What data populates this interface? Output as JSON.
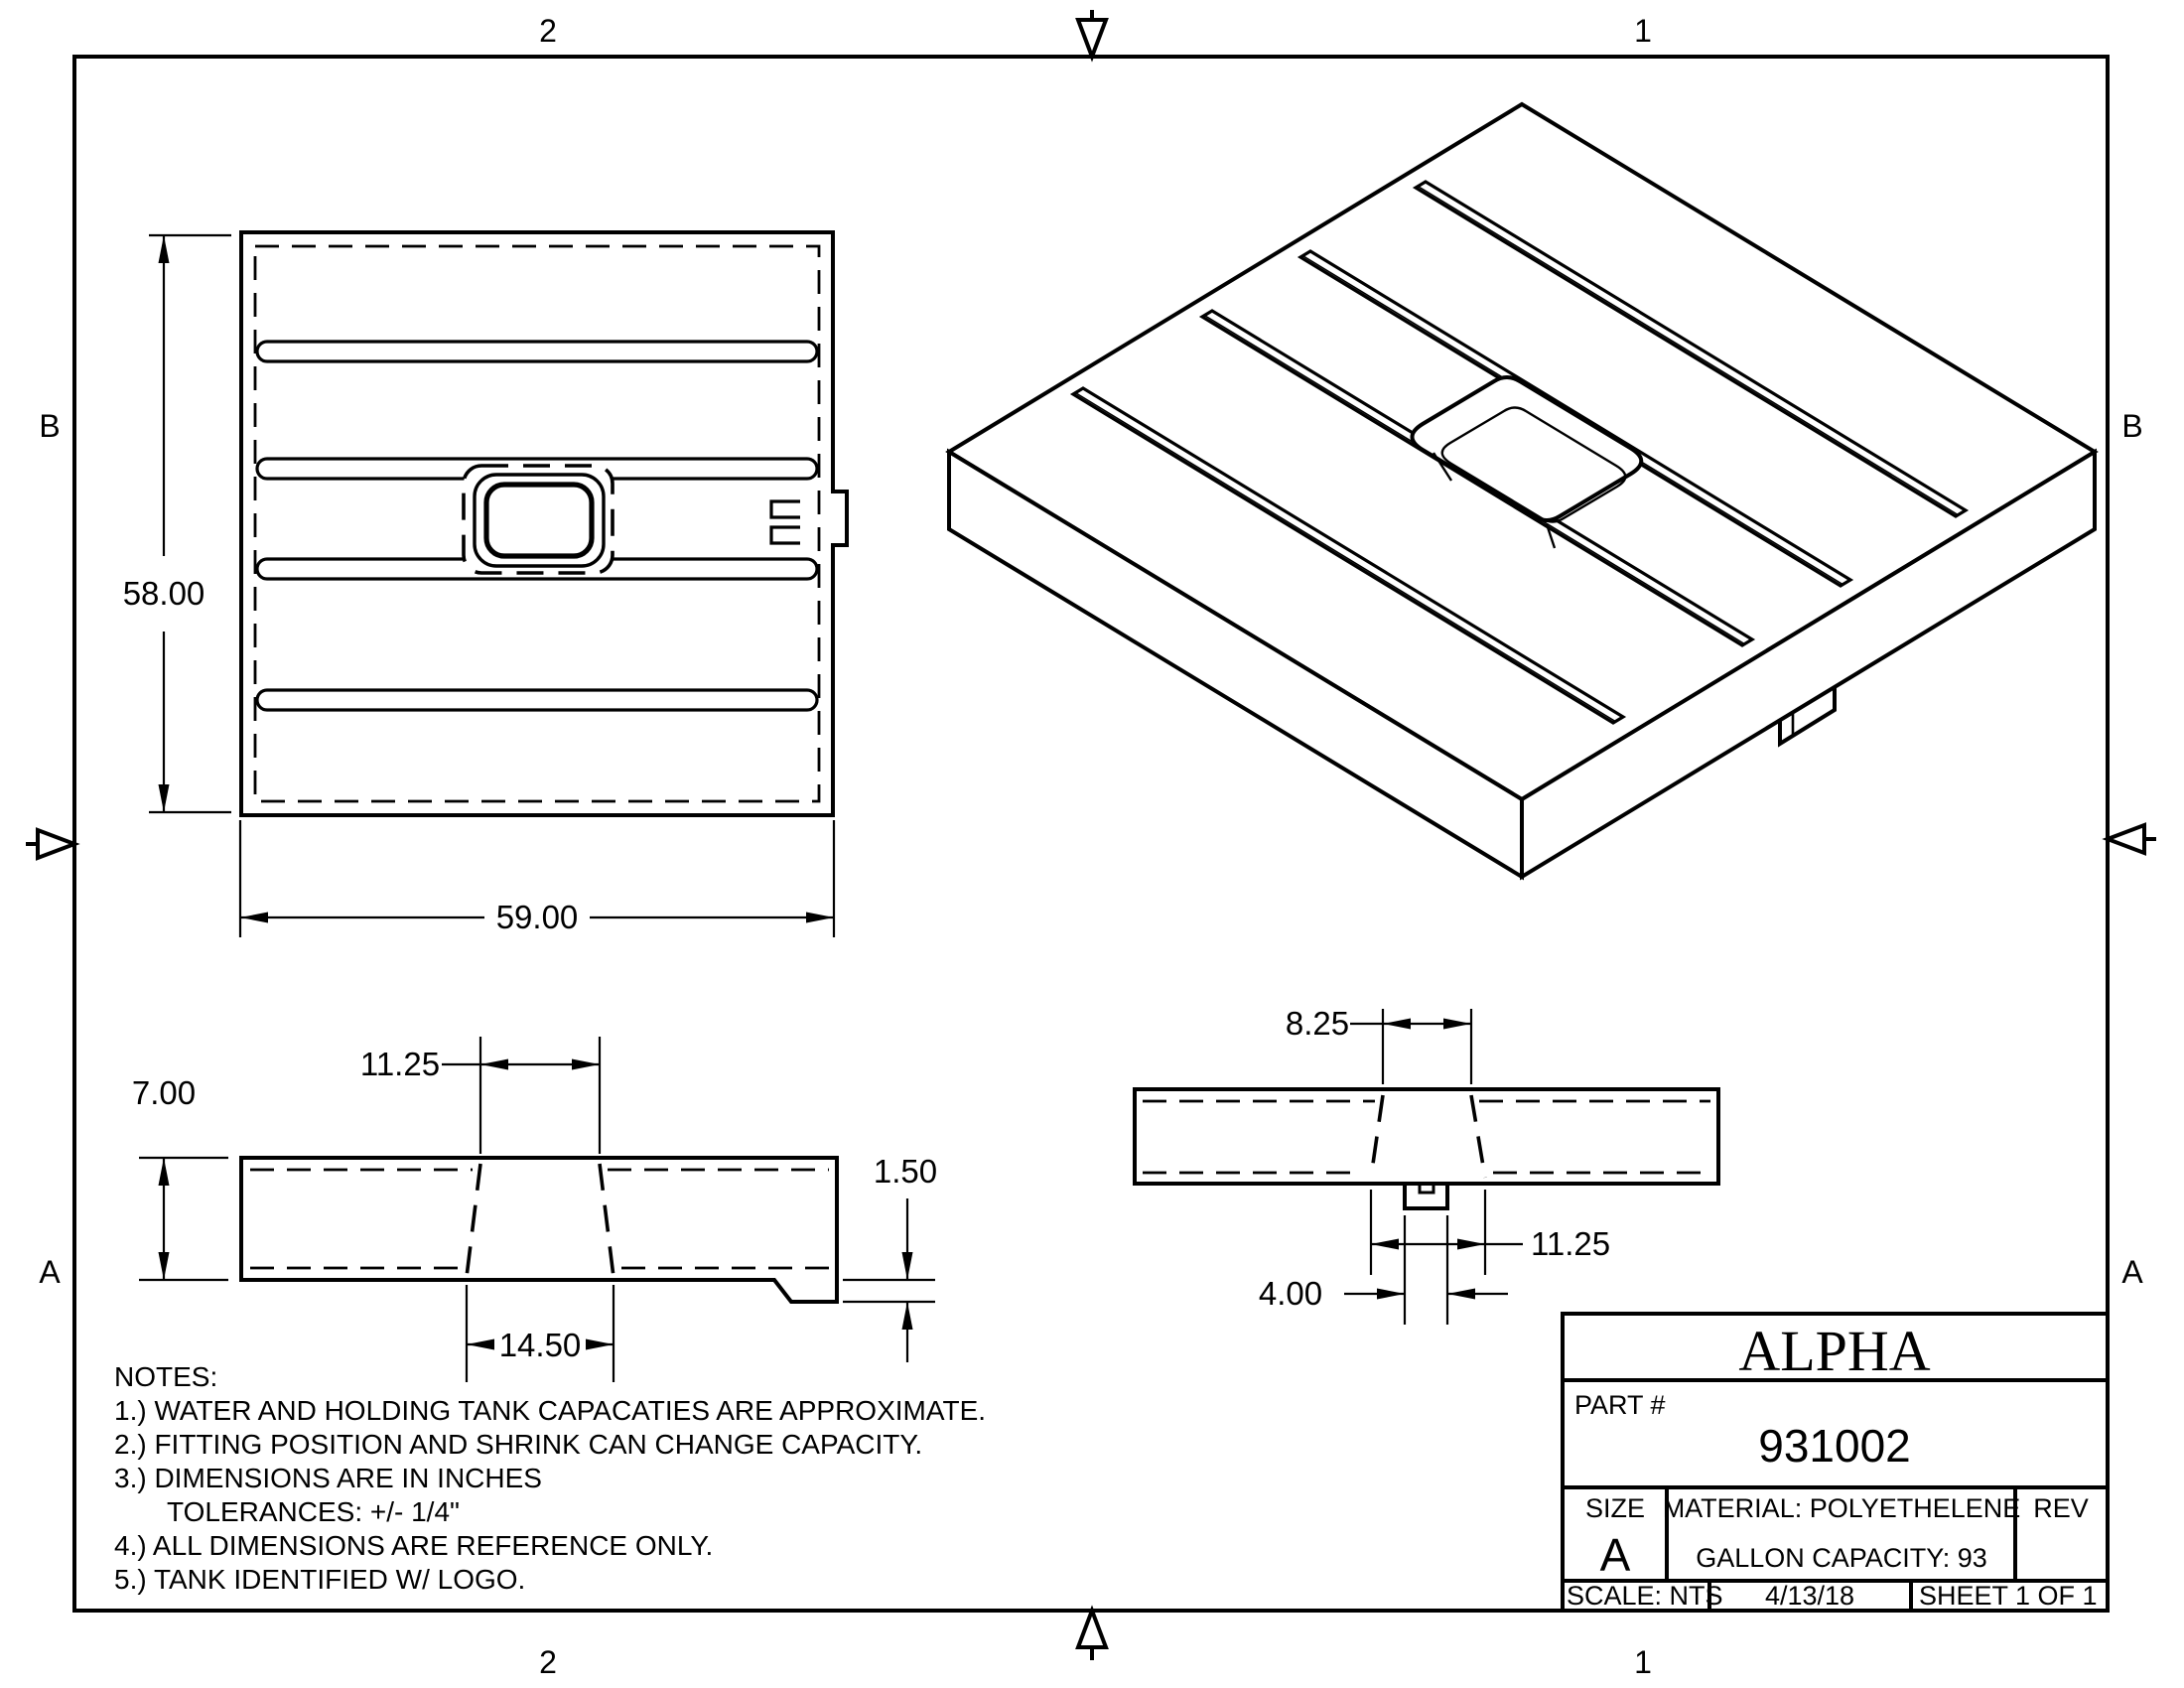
{
  "sheet": {
    "zones": {
      "top_left": "2",
      "top_right": "1",
      "bottom_left": "2",
      "bottom_right": "1",
      "left_upper": "B",
      "left_lower": "A",
      "right_upper": "B",
      "right_lower": "A"
    }
  },
  "views": {
    "top_view": {
      "height_dim": "58.00",
      "width_dim": "59.00"
    },
    "side_section": {
      "thickness_dim": "7.00",
      "opening_top_dim": "11.25",
      "opening_bottom_dim": "14.50",
      "step_dim": "1.50"
    },
    "end_section": {
      "opening_top_dim": "8.25",
      "opening_bottom_dim": "11.25",
      "lip_dim": "4.00"
    }
  },
  "notes": {
    "title": "NOTES:",
    "items": [
      "1.) WATER AND HOLDING TANK CAPACATIES ARE APPROXIMATE.",
      "2.) FITTING POSITION AND SHRINK CAN CHANGE CAPACITY.",
      "3.) DIMENSIONS ARE IN INCHES",
      "TOLERANCES: +/-  1/4\"",
      "4.) ALL DIMENSIONS ARE REFERENCE ONLY.",
      "5.) TANK IDENTIFIED W/ LOGO."
    ]
  },
  "title_block": {
    "brand": "ALPHA",
    "part_label": "PART #",
    "part_number": "931002",
    "size_label": "SIZE",
    "size_value": "A",
    "material": "MATERIAL: POLYETHELENE",
    "capacity": "GALLON CAPACITY: 93",
    "rev_label": "REV",
    "scale": "SCALE: NTS",
    "date": "4/13/18",
    "sheet": "SHEET 1  OF 1"
  },
  "colors": {
    "ink": "#000000",
    "paper": "#ffffff"
  }
}
